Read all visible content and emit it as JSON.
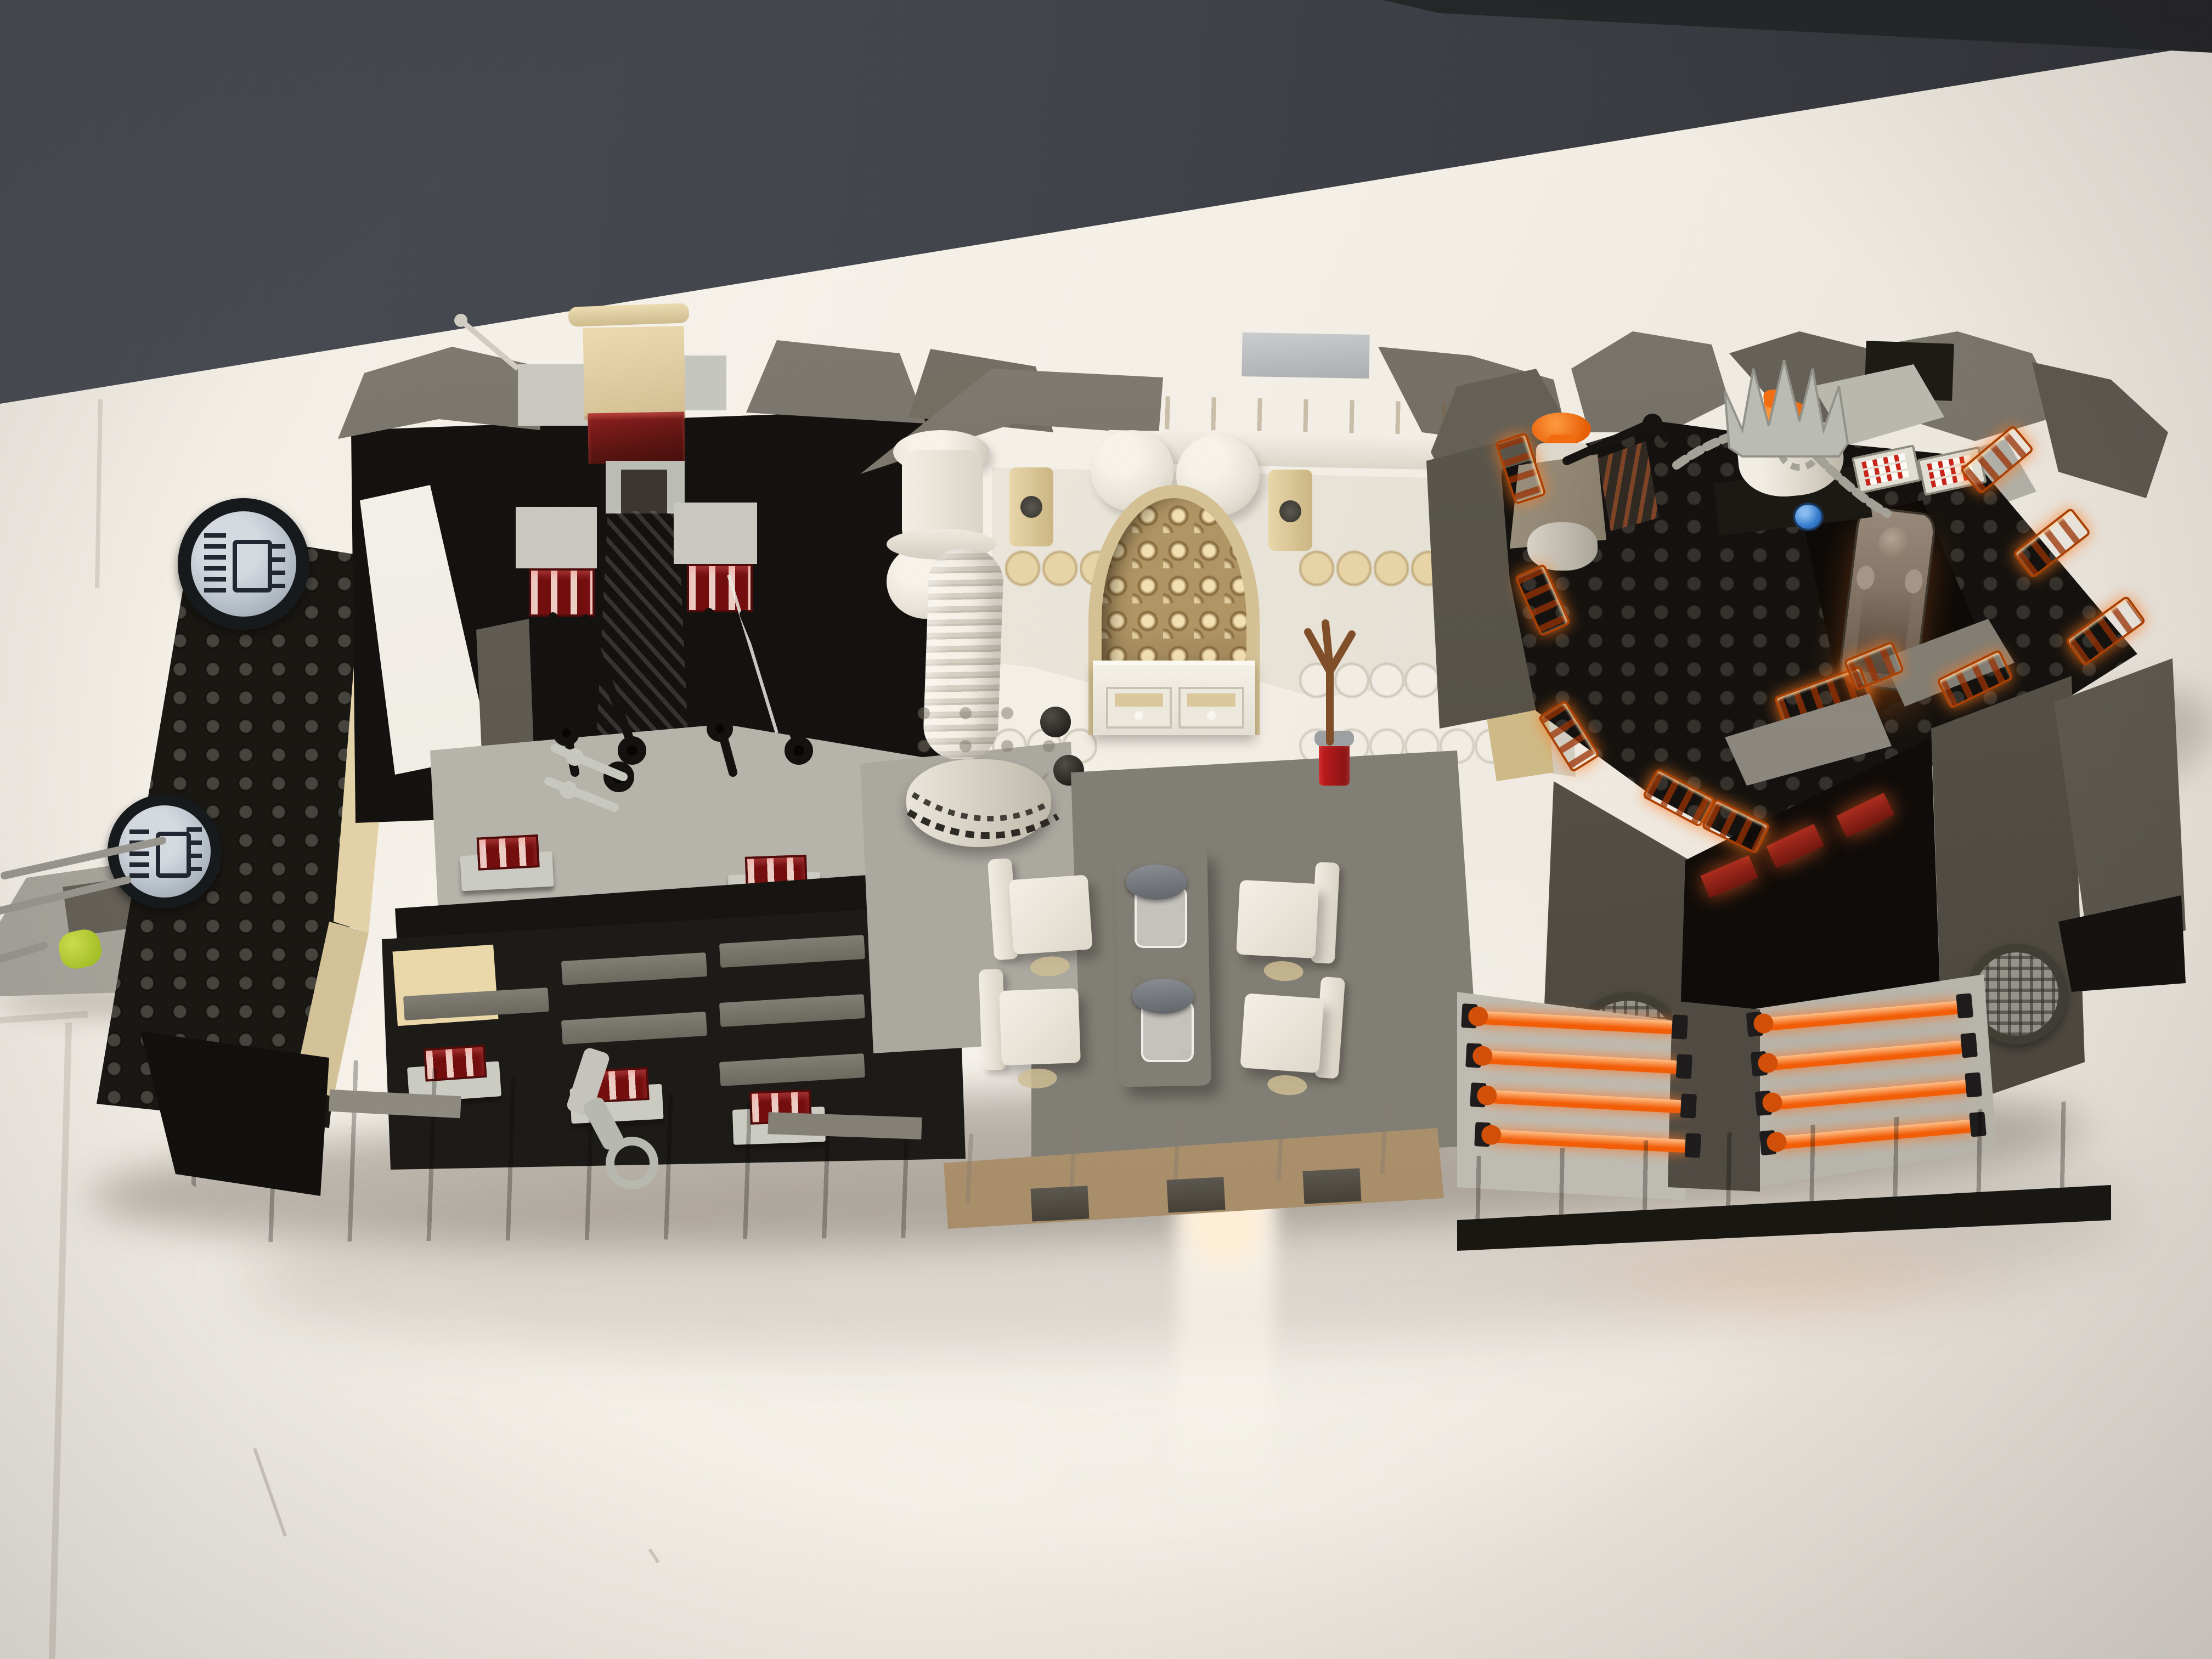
{
  "meta": {
    "aria_label": "Photograph of a LEGO Star Wars Cloud City style diorama standing on a glossy white table in front of a dark grey wall"
  },
  "palette": {
    "wall": "#3c414b",
    "wallDark": "#1e2227",
    "tableHi": "#f5f3ee",
    "tableLo": "#e4e1db",
    "blackBrick": "#121210",
    "darkGray": "#57554f",
    "darkGrayHi": "#6e6b64",
    "lightGray": "#b5b5ae",
    "lightGrayHi": "#c9ccc6",
    "tan": "#d9c89e",
    "tanBright": "#ead9ac",
    "whiteBrick": "#eae7df",
    "transRed": "#58100f",
    "redGrille": "#7c0e12",
    "transOrange": "#f25a05",
    "transOrangeHi": "#ff9a3d",
    "lime": "#b8d437",
    "silver": "#7e8388",
    "chain": "#a0a09a",
    "brown": "#7c4c28",
    "blueTile": "#2e7ad0",
    "hanBlock": "#807266",
    "floorMid": "#7d7c76",
    "terrace": "#b3b3ad"
  },
  "scene": {
    "background": {
      "wall": "plain dark grey wall across the top",
      "surface": "glossy white table top with faint tile seams, soft shadows and a bright reflection streak"
    },
    "model": {
      "left_walkway": {
        "label": "light grey walkway stub with lime-green trans pieces and thin grey antenna bars running off frame"
      },
      "left_tower": {
        "label": "black leaning tower with tan corner bricks and smoked window panels",
        "stickers": [
          "round printed machinery tile on top",
          "round printed machinery tile at lower left"
        ]
      },
      "gate_room": {
        "label": "black control room with grey rock-slope wings",
        "details": [
          "tan hinge-bar topper above a trans dark-red brick",
          "white sloped panel ramp",
          "silver metallic chute",
          "two light-grey pillar blocks with trans-red grilles and hanging black mechanical arms",
          "light-grey studded terrace with trans-red grille vents",
          "stepped black floor with dark-grey tile treads and one tan tile",
          "three trans-red grille vents on light-grey plates at the front edge",
          "grey nozzle lever hanging over the dark grey base"
        ]
      },
      "dining_room": {
        "label": "white and tan Cloud City dining room",
        "details": [
          "grey sloped roof with light-grey cap tile and tan fascia strip",
          "white walls with round cylinder bumps and tan scallop courses",
          "tan arched doorway filled with studded lattice texture",
          "white spiral-ribbed column on a round studded base with black ball chain",
          "white sideboard with two tan-fronted drawers",
          "white dining table with two grey goblets on clear stands",
          "four white chairs on tan feet",
          "reddish-brown three-prong stand in a trans-red holder",
          "grey studded floor and white tiled front edge over a notched base"
        ]
      },
      "carbon_freezing_chamber": {
        "label": "black carbon-freezing platform trimmed with glowing trans-neon-orange grilles",
        "details": [
          "black studded deck ringed by trans-orange grille tiles",
          "Han-Solo-in-carbonite printed block standing in the centre pit",
          "white cylinder freezing machine with orange cap wrapped in a grey chain",
          "grey spiked crown piece behind the machine",
          "two printed gauge tiles with red tick marks",
          "single blue round tile",
          "orange-capped barrel machine with a black lever",
          "dark grey rock slopes and light grey wedges",
          "two dark grey legs with round vent grilles and a glowing gap between them",
          "eight trans-orange rail bars clipped over light-grey plates",
          "dark grey brick base with black trim"
        ]
      }
    },
    "lighting": {
      "notes": "warm indoor light from upper left, soft shadow under the model, glossy hotspot reflection on the table below the centre"
    }
  }
}
